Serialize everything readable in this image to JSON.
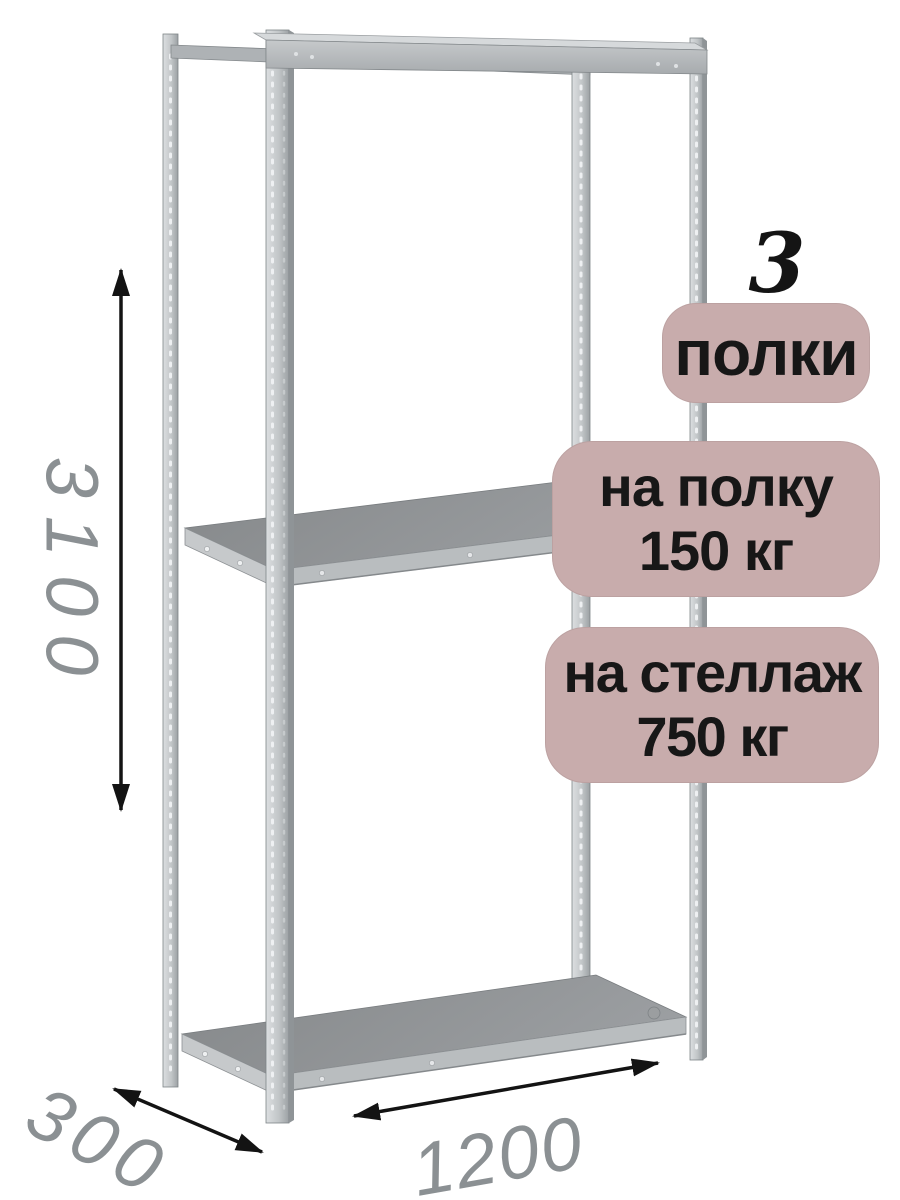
{
  "badges": {
    "count": "3",
    "count_label": "полки",
    "shelf_load_line1": "на полку",
    "shelf_load_line2": "150 кг",
    "rack_load_line1": "на стеллаж",
    "rack_load_line2": "750 кг"
  },
  "dimensions": {
    "height": "3100",
    "depth": "300",
    "width": "1200"
  },
  "icons": {
    "height_arrow": "vertical double-headed arrow",
    "depth_arrow": "diagonal double-headed arrow",
    "width_arrow": "horizontal double-headed arrow"
  },
  "colors": {
    "background": "#ffffff",
    "badge_bg": "#c8acac",
    "badge_text": "#171717",
    "count_text": "#141414",
    "dimension_text": "#8b9093",
    "arrow": "#131313",
    "metal_light": "#d6d9db",
    "metal_mid": "#b4b8ba",
    "metal_dark": "#8e9092"
  }
}
